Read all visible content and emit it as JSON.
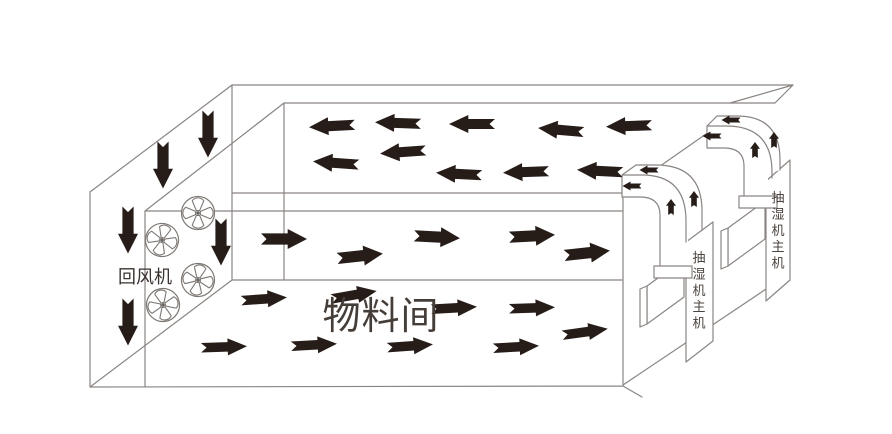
{
  "diagram_title": "drying-room-airflow-schematic",
  "colors": {
    "background": "#ffffff",
    "line": "#8a8582",
    "arrow": "#261c18",
    "label_dark": "#3a322e",
    "room_label": "#453d38",
    "unit_label": "#4a423e"
  },
  "labels": {
    "return_fan": {
      "text": "回风机"
    },
    "material_room": {
      "text": "物料间"
    },
    "dehumidifier_unit": {
      "text": "抽湿机主机"
    }
  },
  "units": [
    {
      "label": "抽湿机主机",
      "cx": 699,
      "top": 262,
      "step": 16.4,
      "size": 13
    },
    {
      "label": "抽湿机主机",
      "cx": 778,
      "top": 202,
      "step": 16.4,
      "size": 13
    }
  ],
  "fans": {
    "icon": "axial-fan-icon",
    "radius": 16.5,
    "positions": [
      {
        "x": 162,
        "y": 240,
        "rot": 15
      },
      {
        "x": 198,
        "y": 213,
        "rot": 0
      },
      {
        "x": 198,
        "y": 280,
        "rot": 10
      },
      {
        "x": 163,
        "y": 305,
        "rot": -12
      }
    ]
  },
  "airflow": {
    "ceiling_return": {
      "description": "return air flowing left in top plenum",
      "direction": "left",
      "size": [
        46,
        18
      ],
      "arrows": [
        [
          332,
          126,
          -3
        ],
        [
          398,
          123,
          2
        ],
        [
          472,
          124,
          0
        ],
        [
          561,
          130,
          5
        ],
        [
          629,
          126,
          -2
        ],
        [
          336,
          163,
          4
        ],
        [
          403,
          152,
          -4
        ],
        [
          459,
          174,
          3
        ],
        [
          526,
          172,
          -2
        ],
        [
          600,
          171,
          3
        ]
      ]
    },
    "middle_supply": {
      "description": "air flowing right through upper room level",
      "direction": "right",
      "size": [
        46,
        20
      ],
      "arrows": [
        [
          284,
          239,
          0
        ],
        [
          360,
          256,
          -6
        ],
        [
          437,
          237,
          3
        ],
        [
          532,
          236,
          -3
        ],
        [
          587,
          253,
          -6
        ]
      ]
    },
    "floor_supply": {
      "description": "air flowing right through lower room level",
      "direction": "right",
      "size": [
        46,
        17
      ],
      "arrows": [
        [
          264,
          299,
          -4
        ],
        [
          354,
          295,
          -10
        ],
        [
          454,
          308,
          -3
        ],
        [
          532,
          308,
          -2
        ],
        [
          585,
          332,
          -8
        ],
        [
          224,
          347,
          -2
        ],
        [
          314,
          345,
          -3
        ],
        [
          410,
          346,
          -4
        ],
        [
          516,
          347,
          -3
        ]
      ]
    },
    "downdraft": {
      "description": "air dropping down through return fan shaft",
      "direction": "down",
      "size": [
        47,
        20
      ],
      "arrows": [
        [
          163,
          165,
          0
        ],
        [
          208,
          134,
          0
        ],
        [
          128,
          230,
          0
        ],
        [
          128,
          322,
          0
        ],
        [
          221,
          242,
          0
        ]
      ]
    },
    "duct_up": {
      "description": "air rising in dehumidifier ducts",
      "direction": "up",
      "size": [
        16,
        10
      ],
      "arrows": [
        [
          671,
          207,
          0
        ],
        [
          694,
          199,
          0
        ],
        [
          755,
          150,
          0
        ],
        [
          774,
          140,
          0
        ]
      ]
    },
    "duct_out": {
      "description": "dehumidified air discharged left into room",
      "direction": "left",
      "size": [
        19,
        9
      ],
      "arrows": [
        [
          649,
          170,
          0
        ],
        [
          632,
          186,
          0
        ],
        [
          731,
          120,
          0
        ],
        [
          712,
          136,
          0
        ]
      ]
    }
  }
}
